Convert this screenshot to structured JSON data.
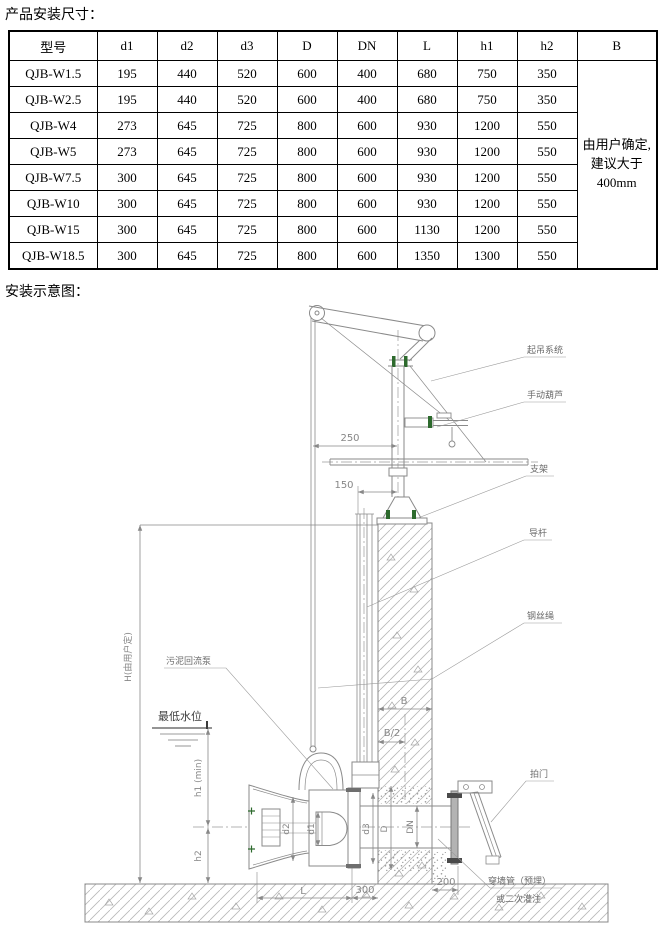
{
  "page": {
    "title1": "产品安装尺寸：",
    "title2": "安装示意图："
  },
  "table": {
    "headers": [
      "型号",
      "d1",
      "d2",
      "d3",
      "D",
      "DN",
      "L",
      "h1",
      "h2",
      "B"
    ],
    "rows": [
      {
        "model": "QJB-W1.5",
        "values": [
          "195",
          "440",
          "520",
          "600",
          "400",
          "680",
          "750",
          "350"
        ]
      },
      {
        "model": "QJB-W2.5",
        "values": [
          "195",
          "440",
          "520",
          "600",
          "400",
          "680",
          "750",
          "350"
        ]
      },
      {
        "model": "QJB-W4",
        "values": [
          "273",
          "645",
          "725",
          "800",
          "600",
          "930",
          "1200",
          "550"
        ]
      },
      {
        "model": "QJB-W5",
        "values": [
          "273",
          "645",
          "725",
          "800",
          "600",
          "930",
          "1200",
          "550"
        ]
      },
      {
        "model": "QJB-W7.5",
        "values": [
          "300",
          "645",
          "725",
          "800",
          "600",
          "930",
          "1200",
          "550"
        ]
      },
      {
        "model": "QJB-W10",
        "values": [
          "300",
          "645",
          "725",
          "800",
          "600",
          "930",
          "1200",
          "550"
        ]
      },
      {
        "model": "QJB-W15",
        "values": [
          "300",
          "645",
          "725",
          "800",
          "600",
          "1130",
          "1200",
          "550"
        ]
      },
      {
        "model": "QJB-W18.5",
        "values": [
          "300",
          "645",
          "725",
          "800",
          "600",
          "1350",
          "1300",
          "550"
        ]
      }
    ],
    "b_note": "由用户确定, 建议大于400mm"
  },
  "diagram": {
    "labels": {
      "lifting_system": "起吊系统",
      "manual_hoist": "手动葫芦",
      "bracket": "支架",
      "guide_rod": "导杆",
      "wire_rope": "钢丝绳",
      "flap_valve": "拍门",
      "wall_pipe_line1": "穿墙管（预埋）",
      "wall_pipe_line2": "或二次灌注",
      "sludge_pump": "污泥回流泵",
      "lowest_water_level": "最低水位"
    },
    "dimensions": {
      "h_total": "H(由用户定)",
      "h1": "h1 (min)",
      "h2": "h2",
      "dim250": "250",
      "dim150": "150",
      "b": "B",
      "b_half": "B/2",
      "l": "L",
      "dim300": "300",
      "dim200": "200",
      "d1": "d1",
      "d2": "d2",
      "d3": "d3",
      "d": "D",
      "dn": "DN"
    }
  },
  "colors": {
    "drawing_line": "#8a8a8a",
    "label_text": "#6a6a6a",
    "bolt_green": "#2d6a2d",
    "table_text": "#000000"
  }
}
